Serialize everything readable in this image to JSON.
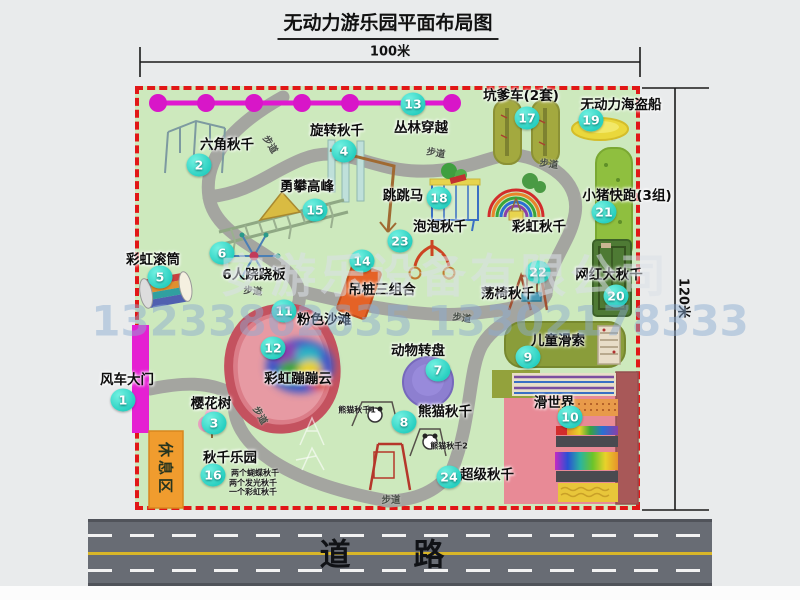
{
  "title": "无动力游乐园平面布局图",
  "dimensions": {
    "top": "100米",
    "right": "120米"
  },
  "road": {
    "label": "道  路"
  },
  "watermark": {
    "company": "安游乐设备有限公司",
    "phones": "13233862635 13302178333"
  },
  "rest_area": {
    "label": "休息区"
  },
  "map": {
    "attractions": [
      {
        "num": "1",
        "label": "风车大门",
        "lx": 127,
        "ly": 378,
        "mx": 123,
        "my": 400
      },
      {
        "num": "2",
        "label": "六角秋千",
        "lx": 227,
        "ly": 143,
        "mx": 199,
        "my": 165
      },
      {
        "num": "3",
        "label": "樱花树",
        "lx": 211,
        "ly": 402,
        "mx": 214,
        "my": 423
      },
      {
        "num": "4",
        "label": "旋转秋千",
        "lx": 337,
        "ly": 129,
        "mx": 344,
        "my": 151
      },
      {
        "num": "5",
        "label": "彩虹滚筒",
        "lx": 153,
        "ly": 258,
        "mx": 160,
        "my": 277
      },
      {
        "num": "6",
        "label": "6人跷跷板",
        "lx": 254,
        "ly": 273,
        "mx": 222,
        "my": 253
      },
      {
        "num": "7",
        "label": "动物转盘",
        "lx": 418,
        "ly": 349,
        "mx": 438,
        "my": 370
      },
      {
        "num": "8",
        "label": "熊猫秋千",
        "lx": 445,
        "ly": 410,
        "mx": 404,
        "my": 422
      },
      {
        "num": "9",
        "label": "儿童滑索",
        "lx": 558,
        "ly": 339,
        "mx": 528,
        "my": 357
      },
      {
        "num": "10",
        "label": "滑世界",
        "lx": 554,
        "ly": 401,
        "mx": 570,
        "my": 417
      },
      {
        "num": "11",
        "label": "粉色沙滩",
        "lx": 324,
        "ly": 318,
        "mx": 284,
        "my": 311
      },
      {
        "num": "12",
        "label": "彩虹蹦蹦云",
        "lx": 298,
        "ly": 377,
        "mx": 273,
        "my": 348
      },
      {
        "num": "13",
        "label": "丛林穿越",
        "lx": 421,
        "ly": 126,
        "mx": 413,
        "my": 104
      },
      {
        "num": "14",
        "label": "吊桩三组合",
        "lx": 382,
        "ly": 288,
        "mx": 362,
        "my": 261
      },
      {
        "num": "15",
        "label": "勇攀高峰",
        "lx": 307,
        "ly": 185,
        "mx": 315,
        "my": 210
      },
      {
        "num": "16",
        "label": "秋千乐园",
        "lx": 230,
        "ly": 456,
        "mx": 213,
        "my": 475
      },
      {
        "num": "17",
        "label": "坑爹车(2套)",
        "lx": 521,
        "ly": 94,
        "mx": 527,
        "my": 118
      },
      {
        "num": "18",
        "label": "跳跳马",
        "lx": 403,
        "ly": 194,
        "mx": 439,
        "my": 198
      },
      {
        "num": "19",
        "label": "无动力海盗船",
        "lx": 621,
        "ly": 103,
        "mx": 591,
        "my": 120
      },
      {
        "num": "20",
        "label": "网红大秋千",
        "lx": 609,
        "ly": 273,
        "mx": 616,
        "my": 296
      },
      {
        "num": "21",
        "label": "小猪快跑(3组)",
        "lx": 627,
        "ly": 194,
        "mx": 604,
        "my": 212
      },
      {
        "num": "22",
        "label": "荡椅秋千",
        "lx": 508,
        "ly": 292,
        "mx": 538,
        "my": 272
      },
      {
        "num": "23",
        "label": "泡泡秋千",
        "lx": 440,
        "ly": 225,
        "mx": 400,
        "my": 241
      },
      {
        "num": "24",
        "label": "超级秋千",
        "lx": 487,
        "ly": 473,
        "mx": 449,
        "my": 477
      },
      {
        "num": null,
        "label": "彩虹秋千",
        "lx": 539,
        "ly": 225
      }
    ],
    "path_labels": [
      {
        "text": "步道",
        "x": 271,
        "y": 144,
        "rot": 58
      },
      {
        "text": "步道",
        "x": 436,
        "y": 152,
        "rot": 10
      },
      {
        "text": "步道",
        "x": 549,
        "y": 163,
        "rot": 8
      },
      {
        "text": "步道",
        "x": 253,
        "y": 290,
        "rot": 5
      },
      {
        "text": "步道",
        "x": 462,
        "y": 317,
        "rot": 8
      },
      {
        "text": "步道",
        "x": 261,
        "y": 415,
        "rot": 60
      },
      {
        "text": "步道",
        "x": 391,
        "y": 499,
        "rot": 0
      }
    ],
    "notes": [
      {
        "text": "熊猫秋千1",
        "x": 357,
        "y": 410
      },
      {
        "text": "熊猫秋千2",
        "x": 449,
        "y": 446
      },
      {
        "text": "两个蝴蝶秋千",
        "x": 255,
        "y": 473
      },
      {
        "text": "两个发光秋千",
        "x": 253,
        "y": 483
      },
      {
        "text": "一个彩虹秋千",
        "x": 253,
        "y": 492
      }
    ]
  }
}
